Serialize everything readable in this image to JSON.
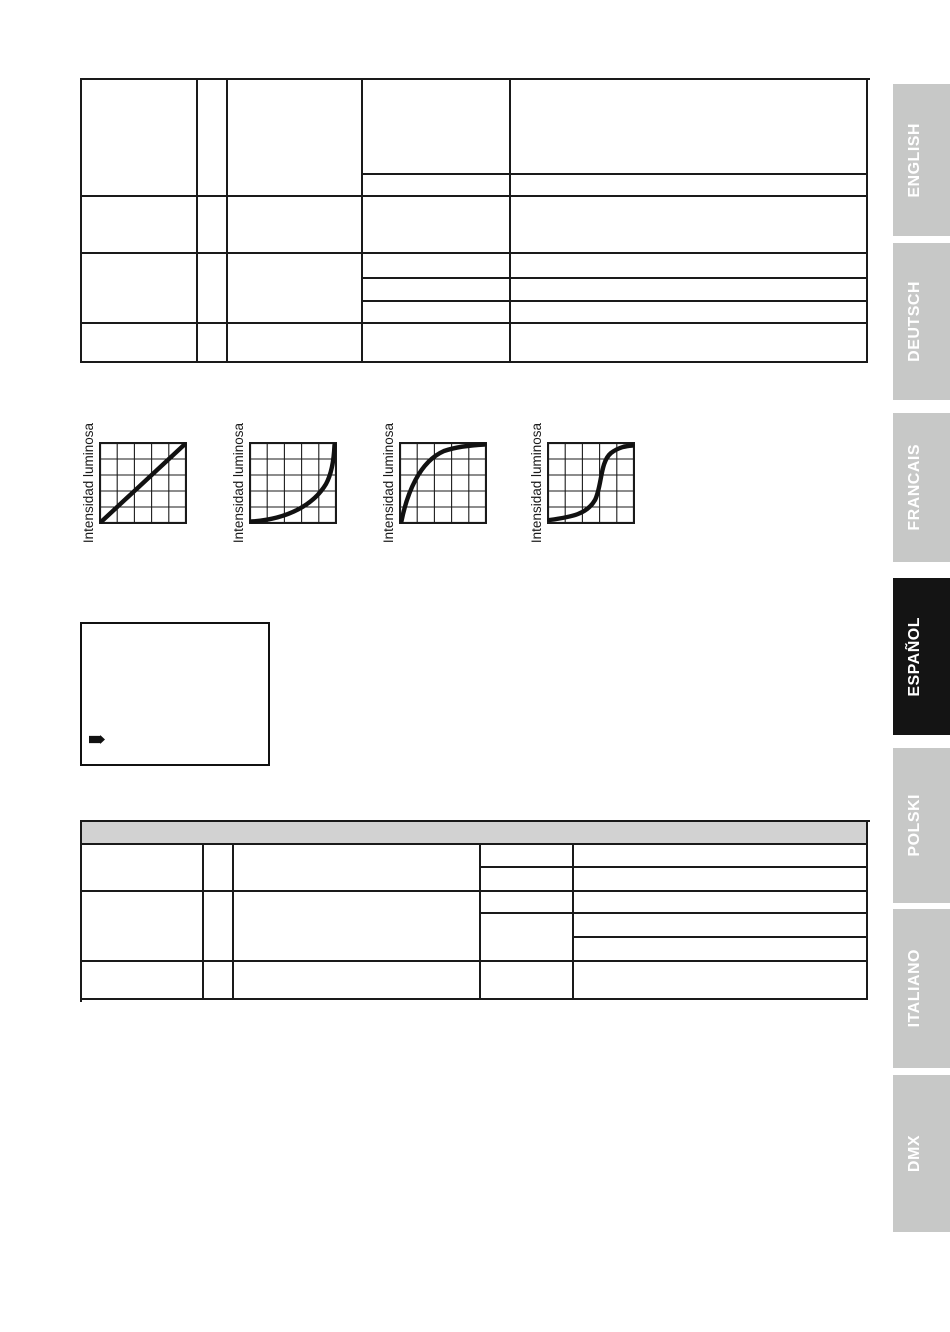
{
  "document": {
    "kind": "scanned-manual-page",
    "visible_section": "ESPAÑOL"
  },
  "sidebar": {
    "tabs": [
      {
        "label": "ENGLISH",
        "active": false
      },
      {
        "label": "DEUTSCH",
        "active": false
      },
      {
        "label": "FRANCAIS",
        "active": false
      },
      {
        "label": "ESPAÑOL",
        "active": true
      },
      {
        "label": "POLSKI",
        "active": false
      },
      {
        "label": "ITALIANO",
        "active": false
      },
      {
        "label": "DMX",
        "active": false
      }
    ],
    "colors": {
      "inactive_bg": "#c7c8c7",
      "active_bg": "#141414",
      "text": "#ffffff"
    }
  },
  "charts": {
    "ylabel": "Intensidad luminosa",
    "items": [
      {
        "curve": "linear"
      },
      {
        "curve": "exponential"
      },
      {
        "curve": "logarithmic"
      },
      {
        "curve": "s-curve"
      }
    ]
  },
  "chart_data": [
    {
      "type": "line",
      "title": "",
      "xlabel": "",
      "ylabel": "Intensidad luminosa",
      "curve": "linear",
      "grid": "5x5",
      "tick_labels": "none",
      "x_norm": [
        0,
        0.25,
        0.5,
        0.75,
        1
      ],
      "y_norm": [
        0,
        0.25,
        0.5,
        0.75,
        1
      ]
    },
    {
      "type": "line",
      "title": "",
      "xlabel": "",
      "ylabel": "Intensidad luminosa",
      "curve": "exponential",
      "grid": "5x5",
      "tick_labels": "none",
      "x_norm": [
        0,
        0.25,
        0.5,
        0.75,
        1
      ],
      "y_norm": [
        0,
        0.05,
        0.15,
        0.45,
        1
      ]
    },
    {
      "type": "line",
      "title": "",
      "xlabel": "",
      "ylabel": "Intensidad luminosa",
      "curve": "logarithmic",
      "grid": "5x5",
      "tick_labels": "none",
      "x_norm": [
        0,
        0.25,
        0.5,
        0.75,
        1
      ],
      "y_norm": [
        0,
        0.55,
        0.8,
        0.93,
        1
      ]
    },
    {
      "type": "line",
      "title": "",
      "xlabel": "",
      "ylabel": "Intensidad luminosa",
      "curve": "s-curve",
      "grid": "5x5",
      "tick_labels": "none",
      "x_norm": [
        0,
        0.25,
        0.5,
        0.75,
        1
      ],
      "y_norm": [
        0,
        0.08,
        0.35,
        0.9,
        1
      ]
    }
  ],
  "tables": {
    "top_table": {
      "cells_empty": true,
      "border_color": "#1a1a1a"
    },
    "bottom_table": {
      "cells_empty": true,
      "header_bg": "#d2d2d2",
      "border_color": "#1a1a1a"
    }
  },
  "display_box": {
    "icon": "arrow-right-icon",
    "content": ""
  }
}
